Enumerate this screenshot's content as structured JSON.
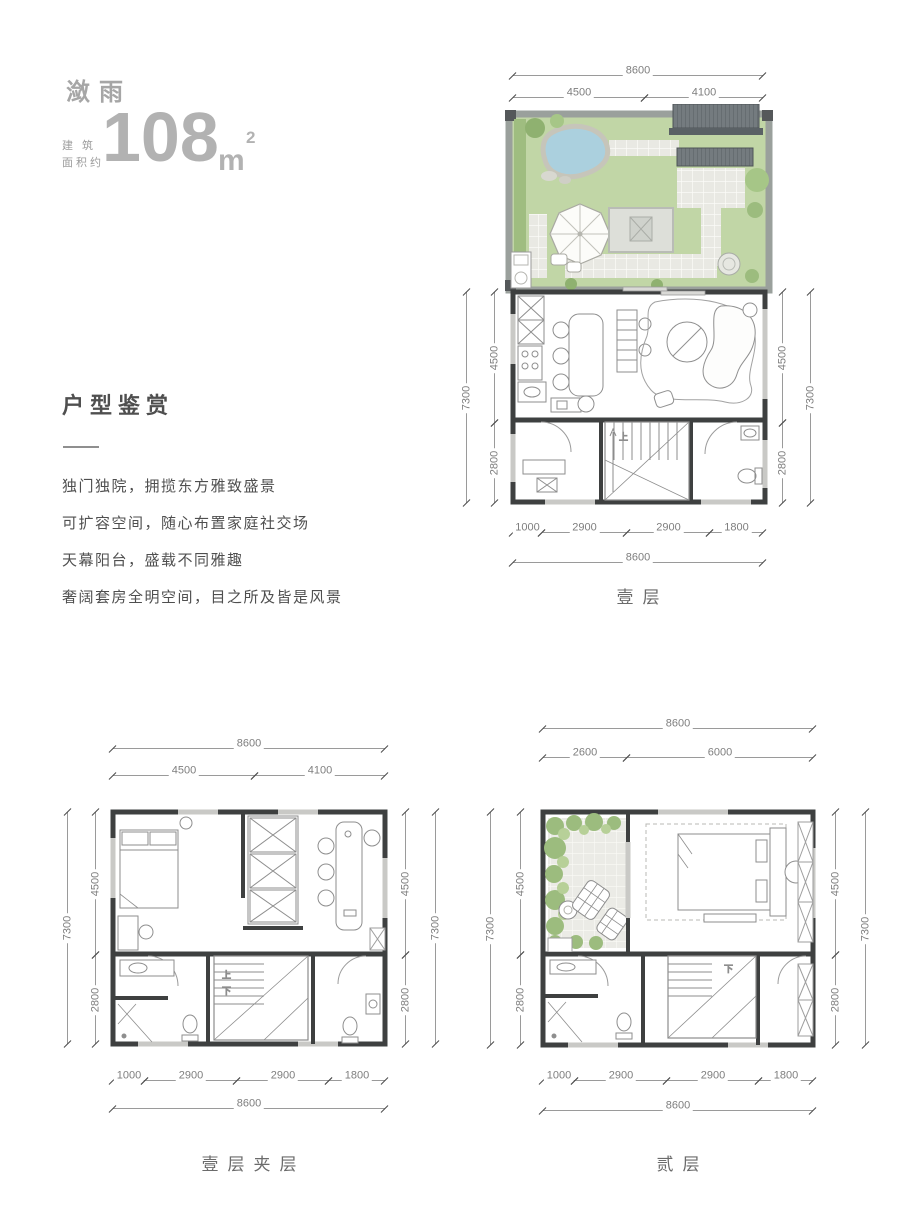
{
  "header": {
    "name": "潋雨",
    "area_label_line1": "建 筑",
    "area_label_line2": "面积约",
    "area_value": "108",
    "area_unit": "m",
    "area_exponent": "2"
  },
  "section": {
    "title": "户型鉴赏",
    "features": [
      "独门独院，拥揽东方雅致盛景",
      "可扩容空间，随心布置家庭社交场",
      "天幕阳台，盛载不同雅趣",
      "奢阔套房全明空间，目之所及皆是风景"
    ]
  },
  "plans": {
    "floor1": {
      "name": "壹层",
      "stair_up": "上",
      "dims": {
        "top_total": "8600",
        "top_left": "4500",
        "top_right": "4100",
        "side_total": "7300",
        "side_upper": "4500",
        "side_lower": "2800",
        "bottom_1": "1000",
        "bottom_2": "2900",
        "bottom_3": "2900",
        "bottom_4": "1800",
        "bottom_total": "8600"
      }
    },
    "mezzanine": {
      "name": "壹层夹层",
      "stair_up": "上",
      "stair_down": "下",
      "dims": {
        "top_total": "8600",
        "top_left": "4500",
        "top_right": "4100",
        "side_total": "7300",
        "side_upper": "4500",
        "side_lower": "2800",
        "bottom_1": "1000",
        "bottom_2": "2900",
        "bottom_3": "2900",
        "bottom_4": "1800",
        "bottom_total": "8600"
      }
    },
    "floor2": {
      "name": "贰层",
      "stair_down": "下",
      "dims": {
        "top_total": "8600",
        "top_left": "2600",
        "top_right": "6000",
        "side_total": "7300",
        "side_upper": "4500",
        "side_lower": "2800",
        "bottom_1": "1000",
        "bottom_2": "2900",
        "bottom_3": "2900",
        "bottom_4": "1800",
        "bottom_total": "8600"
      }
    }
  },
  "colors": {
    "lawn": "#c1d6a6",
    "shrub": "#9cbc7e",
    "pond": "#abd0de",
    "roof": "#747b7f",
    "wall": "#3e4040",
    "paving": "#e9e9e3",
    "dim_line": "#9a9a9a",
    "text_gray": "#4f4f4f",
    "title_gray": "#a6a6a6"
  }
}
